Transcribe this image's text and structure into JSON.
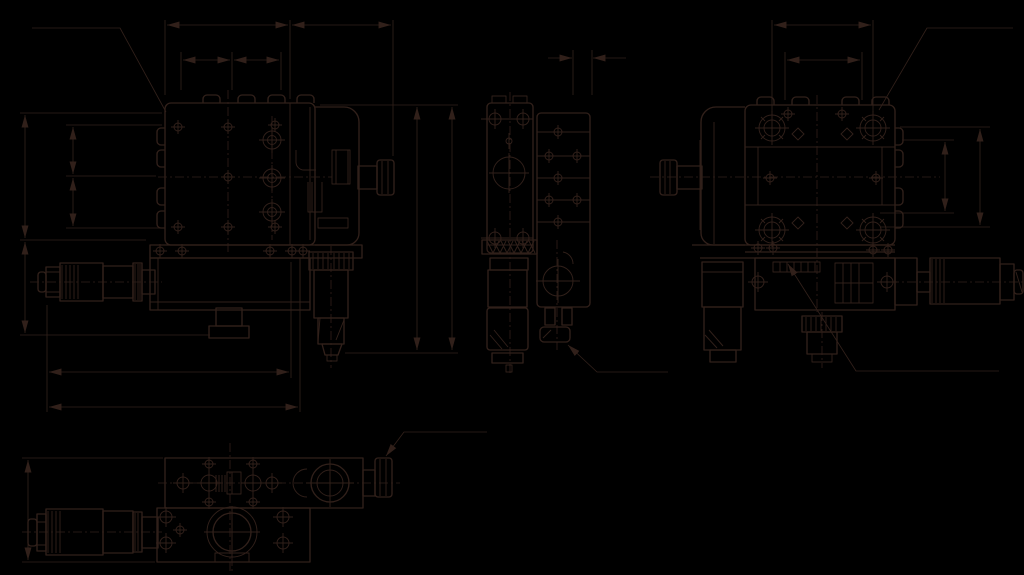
{
  "drawing": {
    "kind": "technical-dimension-drawing",
    "subject": "xy-translation-stage-with-micrometer-heads",
    "canvas": {
      "width": 1024,
      "height": 575
    },
    "colors": {
      "background": "#000000",
      "line": "#31201a"
    },
    "text_labels": [],
    "views": [
      {
        "id": "front-view",
        "position": "top-left",
        "parts": [
          "main-plate",
          "mounting-holes",
          "micrometer-left",
          "micrometer-bottom",
          "locking-foot",
          "side-flange",
          "drive-knob"
        ],
        "annotations": [
          "leader-line",
          "chained-width-dimensions",
          "chained-height-dimensions",
          "overall-width-dimensions",
          "overall-height-dimensions"
        ]
      },
      {
        "id": "side-view",
        "position": "top-center",
        "parts": [
          "left-slab",
          "right-slab",
          "micrometer-bottom",
          "lock-knob"
        ],
        "annotations": [
          "gap-dimension",
          "leader-line"
        ]
      },
      {
        "id": "rear-view",
        "position": "top-right",
        "parts": [
          "main-plate",
          "corner-rosettes",
          "left-knob",
          "micrometer-right",
          "micrometer-bottom",
          "gib-block"
        ],
        "annotations": [
          "leader-line-top",
          "leader-line-bottom",
          "width-dimensions",
          "height-dimensions"
        ]
      },
      {
        "id": "bottom-view",
        "position": "bottom-left",
        "parts": [
          "upper-body",
          "lower-body",
          "micrometer-left",
          "drive-knob",
          "bearing-circle"
        ],
        "annotations": [
          "height-dimension",
          "leader-line"
        ]
      }
    ]
  }
}
